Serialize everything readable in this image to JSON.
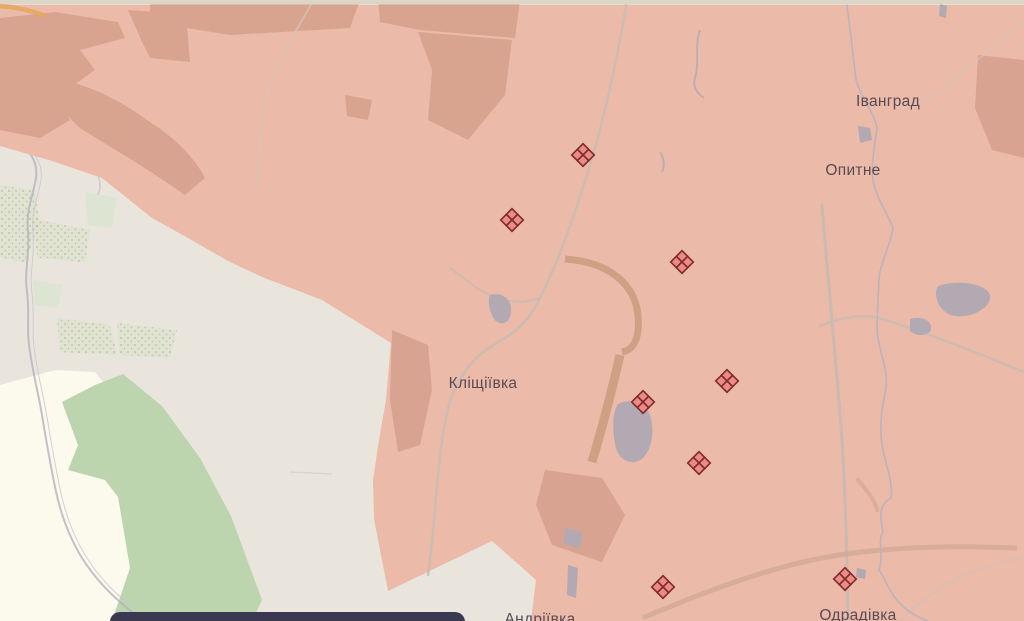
{
  "map": {
    "place_labels": [
      {
        "name": "Іванград",
        "x": 888,
        "y": 106
      },
      {
        "name": "Опитне",
        "x": 853,
        "y": 175
      },
      {
        "name": "Кліщіївка",
        "x": 483,
        "y": 388
      },
      {
        "name": "Андріївка",
        "x": 540,
        "y": 624
      },
      {
        "name": "Одрадівка",
        "x": 858,
        "y": 620
      }
    ],
    "markers": [
      {
        "type": "clash-diamond",
        "x": 583,
        "y": 155
      },
      {
        "type": "clash-diamond",
        "x": 512,
        "y": 220
      },
      {
        "type": "clash-diamond",
        "x": 682,
        "y": 262
      },
      {
        "type": "clash-diamond",
        "x": 727,
        "y": 381
      },
      {
        "type": "clash-diamond",
        "x": 643,
        "y": 402
      },
      {
        "type": "clash-diamond",
        "x": 699,
        "y": 463
      },
      {
        "type": "clash-diamond",
        "x": 663,
        "y": 587
      },
      {
        "type": "clash-diamond",
        "x": 845,
        "y": 579
      }
    ],
    "colors": {
      "base": "#e9e5dc",
      "field_cream": "#fcf9ed",
      "forest_green": "#bcd5af",
      "pale_green": "#dde4d2",
      "occupied_fill": "#ecbaa9",
      "forest_under_occupied": "#d6a28e",
      "water": "#b3a9b3",
      "marker_fill": "#ee8a86",
      "marker_stroke": "#7c2d2d",
      "label_text": "#574a55",
      "panel": "#3b3952"
    }
  }
}
